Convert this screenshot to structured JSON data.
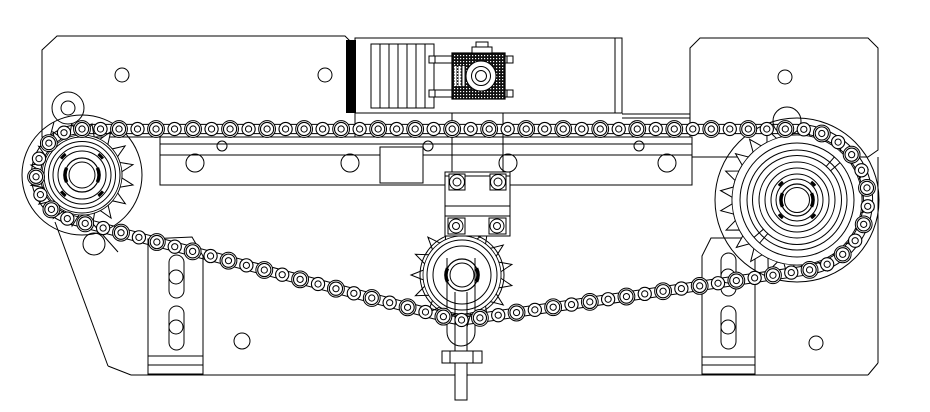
{
  "meta": {
    "background": "#ffffff",
    "line_color": "#000000",
    "fill_color": "#ffffff"
  },
  "canvas": {
    "width": 930,
    "height": 412
  },
  "chain": {
    "pitch": 18.5,
    "roller_outer_r": 6.6,
    "roller_inner_r": 3.1,
    "link_plate_r": 8.4,
    "rail_offset": 4.6
  },
  "sprockets": [
    {
      "id": "left",
      "cx": 82,
      "cy": 175,
      "teeth": 16,
      "tip_r": 52,
      "root_r": 40,
      "pitch_r": 46,
      "rings": [
        38,
        33.5,
        29,
        24
      ],
      "bore_r": 17,
      "bore_inner_r": 13,
      "phase": 11,
      "tick_r": 26.5,
      "ticks": [
        45,
        135,
        225,
        315
      ]
    },
    {
      "id": "right",
      "cx": 797,
      "cy": 200,
      "teeth": 24,
      "tip_r": 77,
      "root_r": 65,
      "pitch_r": 71,
      "rings": [
        57,
        50,
        44.5,
        38,
        32,
        26,
        21
      ],
      "bore_r": 16,
      "bore_inner_r": 12.5,
      "phase": 7,
      "tick_r": 23,
      "ticks": [
        45,
        135,
        225,
        315
      ],
      "spokes": {
        "angles": [
          131,
          139,
          311,
          319
        ],
        "r1": 44.5,
        "r2": 57
      }
    },
    {
      "id": "idler",
      "cx": 462,
      "cy": 275,
      "teeth": 15,
      "tip_r": 51,
      "root_r": 39,
      "pitch_r": 45,
      "rings": [
        42,
        35,
        29
      ],
      "bore_r": 16,
      "bore_inner_r": 12,
      "phase": 12
    }
  ],
  "layers": {
    "plates": [
      {
        "t": "poly",
        "pts": [
          [
            42,
            50
          ],
          [
            57,
            36
          ],
          [
            345,
            36
          ],
          [
            355,
            46
          ],
          [
            355,
            137
          ],
          [
            42,
            137
          ]
        ],
        "f": "#fff"
      },
      {
        "t": "rect",
        "x": 355,
        "y": 38,
        "w": 267,
        "h": 75,
        "f": "#fff"
      },
      {
        "t": "line",
        "x1": 615,
        "y1": 38,
        "x2": 615,
        "y2": 113
      },
      {
        "t": "rect",
        "x": 346,
        "y": 40,
        "w": 10,
        "h": 73,
        "f": "#000"
      },
      {
        "t": "poly",
        "pts": [
          [
            690,
            48
          ],
          [
            700,
            38
          ],
          [
            868,
            38
          ],
          [
            878,
            48
          ],
          [
            878,
            150
          ],
          [
            868,
            157
          ],
          [
            690,
            157
          ]
        ],
        "f": "#fff"
      },
      {
        "t": "line",
        "x1": 622,
        "y1": 114,
        "x2": 690,
        "y2": 114
      },
      {
        "t": "line",
        "x1": 622,
        "y1": 118,
        "x2": 690,
        "y2": 118
      },
      {
        "t": "line",
        "x1": 55,
        "y1": 222,
        "x2": 108,
        "y2": 366
      },
      {
        "t": "line",
        "x1": 77,
        "y1": 206,
        "x2": 118,
        "y2": 252
      },
      {
        "t": "line",
        "x1": 108,
        "y1": 366,
        "x2": 131,
        "y2": 375
      },
      {
        "t": "line",
        "x1": 131,
        "y1": 375,
        "x2": 868,
        "y2": 375
      },
      {
        "t": "line",
        "x1": 868,
        "y1": 375,
        "x2": 878,
        "y2": 363
      },
      {
        "t": "line",
        "x1": 878,
        "y1": 363,
        "x2": 878,
        "y2": 157
      },
      {
        "t": "line",
        "x1": 755,
        "y1": 252,
        "x2": 755,
        "y2": 374
      },
      {
        "t": "circle",
        "cx": 122,
        "cy": 75,
        "r": 7
      },
      {
        "t": "circle",
        "cx": 325,
        "cy": 75,
        "r": 7
      },
      {
        "t": "circle",
        "cx": 785,
        "cy": 77,
        "r": 7
      },
      {
        "t": "circle",
        "cx": 242,
        "cy": 341,
        "r": 8
      },
      {
        "t": "circle",
        "cx": 816,
        "cy": 343,
        "r": 7
      },
      {
        "t": "rect",
        "x": 160,
        "y": 137,
        "w": 532,
        "h": 48,
        "f": "#fff"
      },
      {
        "t": "line",
        "x1": 160,
        "y1": 144,
        "x2": 692,
        "y2": 144
      },
      {
        "t": "line",
        "x1": 160,
        "y1": 155,
        "x2": 692,
        "y2": 155
      },
      {
        "t": "rect",
        "x": 380,
        "y": 147,
        "w": 43,
        "h": 36,
        "f": "#fff"
      },
      {
        "t": "circle",
        "cx": 195,
        "cy": 163,
        "r": 9
      },
      {
        "t": "circle",
        "cx": 350,
        "cy": 163,
        "r": 9
      },
      {
        "t": "circle",
        "cx": 508,
        "cy": 163,
        "r": 9
      },
      {
        "t": "circle",
        "cx": 667,
        "cy": 163,
        "r": 9
      },
      {
        "t": "circle",
        "cx": 222,
        "cy": 146,
        "r": 5
      },
      {
        "t": "circle",
        "cx": 428,
        "cy": 146,
        "r": 5
      },
      {
        "t": "circle",
        "cx": 639,
        "cy": 146,
        "r": 5
      },
      {
        "t": "poly",
        "pts": [
          [
            148,
            239
          ],
          [
            192,
            237
          ],
          [
            203,
            256
          ],
          [
            203,
            374
          ],
          [
            148,
            374
          ]
        ],
        "f": "#fff"
      },
      {
        "t": "line",
        "x1": 148,
        "y1": 356,
        "x2": 203,
        "y2": 356
      },
      {
        "t": "line",
        "x1": 148,
        "y1": 365,
        "x2": 203,
        "y2": 365
      },
      {
        "t": "rect",
        "x": 169,
        "y": 255,
        "w": 15,
        "h": 43,
        "rx": 7.5
      },
      {
        "t": "rect",
        "x": 169,
        "y": 306,
        "w": 15,
        "h": 44,
        "rx": 7.5
      },
      {
        "t": "circle",
        "cx": 176,
        "cy": 277,
        "r": 7
      },
      {
        "t": "circle",
        "cx": 176,
        "cy": 327,
        "r": 7
      },
      {
        "t": "poly",
        "pts": [
          [
            702,
            256
          ],
          [
            711,
            238
          ],
          [
            755,
            238
          ],
          [
            755,
            374
          ],
          [
            702,
            374
          ]
        ],
        "f": "#fff"
      },
      {
        "t": "line",
        "x1": 702,
        "y1": 357,
        "x2": 755,
        "y2": 357
      },
      {
        "t": "line",
        "x1": 702,
        "y1": 365,
        "x2": 755,
        "y2": 365
      },
      {
        "t": "rect",
        "x": 721,
        "y": 253,
        "w": 15,
        "h": 43,
        "rx": 7.5
      },
      {
        "t": "rect",
        "x": 721,
        "y": 306,
        "w": 15,
        "h": 43,
        "rx": 7.5
      },
      {
        "t": "circle",
        "cx": 728,
        "cy": 276,
        "r": 7
      },
      {
        "t": "circle",
        "cx": 728,
        "cy": 327,
        "r": 7
      },
      {
        "t": "circle",
        "cx": 82,
        "cy": 175,
        "r": 60
      },
      {
        "t": "circle",
        "cx": 68,
        "cy": 108,
        "r": 16
      },
      {
        "t": "circle",
        "cx": 68,
        "cy": 108,
        "r": 7
      },
      {
        "t": "circle",
        "cx": 94,
        "cy": 244,
        "r": 11
      },
      {
        "t": "line",
        "x1": 54,
        "y1": 122,
        "x2": 46,
        "y2": 152
      },
      {
        "t": "line",
        "x1": 83,
        "y1": 123,
        "x2": 99,
        "y2": 148
      },
      {
        "t": "circle",
        "cx": 797,
        "cy": 200,
        "r": 82
      },
      {
        "t": "circle",
        "cx": 787,
        "cy": 121,
        "r": 14
      }
    ],
    "drive": [
      {
        "t": "rect",
        "x": 371,
        "y": 44,
        "w": 63,
        "h": 64,
        "f": "#fff"
      },
      {
        "t": "line",
        "x1": 380,
        "y1": 44,
        "x2": 380,
        "y2": 108
      },
      {
        "t": "line",
        "x1": 389,
        "y1": 44,
        "x2": 389,
        "y2": 108
      },
      {
        "t": "line",
        "x1": 398,
        "y1": 44,
        "x2": 398,
        "y2": 108
      },
      {
        "t": "line",
        "x1": 407,
        "y1": 44,
        "x2": 407,
        "y2": 108
      },
      {
        "t": "line",
        "x1": 416,
        "y1": 44,
        "x2": 416,
        "y2": 108
      },
      {
        "t": "line",
        "x1": 425,
        "y1": 44,
        "x2": 425,
        "y2": 108
      },
      {
        "t": "rect",
        "x": 429,
        "y": 56,
        "w": 84,
        "h": 7,
        "f": "#fff"
      },
      {
        "t": "rect",
        "x": 429,
        "y": 90,
        "w": 84,
        "h": 7,
        "f": "#fff"
      },
      {
        "t": "line",
        "x1": 435,
        "y1": 56,
        "x2": 435,
        "y2": 63
      },
      {
        "t": "line",
        "x1": 507,
        "y1": 56,
        "x2": 507,
        "y2": 63
      },
      {
        "t": "line",
        "x1": 435,
        "y1": 90,
        "x2": 435,
        "y2": 97
      },
      {
        "t": "line",
        "x1": 507,
        "y1": 90,
        "x2": 507,
        "y2": 97
      },
      {
        "t": "rect",
        "x": 452,
        "y": 53,
        "w": 53,
        "h": 46,
        "f": "url(#hatch)",
        "w2": 1.2
      },
      {
        "t": "line",
        "x1": 455.5,
        "y1": 66,
        "x2": 455.5,
        "y2": 86,
        "col": "#fff",
        "w2": 2
      },
      {
        "t": "line",
        "x1": 459.5,
        "y1": 66,
        "x2": 459.5,
        "y2": 86,
        "col": "#fff",
        "w2": 2
      },
      {
        "t": "line",
        "x1": 463.5,
        "y1": 66,
        "x2": 463.5,
        "y2": 86,
        "col": "#fff",
        "w2": 2
      },
      {
        "t": "circle",
        "cx": 481,
        "cy": 76,
        "r": 15,
        "f": "#fff"
      },
      {
        "t": "circle",
        "cx": 481,
        "cy": 76,
        "r": 9.5,
        "f": "#fff"
      },
      {
        "t": "circle",
        "cx": 481,
        "cy": 76,
        "r": 5.5,
        "f": "#fff"
      },
      {
        "t": "rect",
        "x": 472,
        "y": 47,
        "w": 20,
        "h": 6,
        "f": "#fff"
      },
      {
        "t": "rect",
        "x": 476,
        "y": 42,
        "w": 12,
        "h": 5,
        "f": "#fff"
      },
      {
        "t": "line",
        "x1": 452,
        "y1": 113,
        "x2": 452,
        "y2": 176
      },
      {
        "t": "line",
        "x1": 503,
        "y1": 113,
        "x2": 503,
        "y2": 176
      },
      {
        "t": "rect",
        "x": 445,
        "y": 172,
        "w": 65,
        "h": 64,
        "f": "#fff"
      },
      {
        "t": "line",
        "x1": 445,
        "y1": 176,
        "x2": 510,
        "y2": 176
      },
      {
        "t": "line",
        "x1": 445,
        "y1": 206,
        "x2": 510,
        "y2": 206
      },
      {
        "t": "line",
        "x1": 445,
        "y1": 216,
        "x2": 510,
        "y2": 216
      },
      {
        "t": "rect",
        "x": 449,
        "y": 174,
        "w": 16,
        "h": 16,
        "f": "#fff"
      },
      {
        "t": "rect",
        "x": 490,
        "y": 174,
        "w": 16,
        "h": 16,
        "f": "#fff"
      },
      {
        "t": "circle",
        "cx": 457,
        "cy": 182,
        "r": 7.5,
        "f": "#fff"
      },
      {
        "t": "circle",
        "cx": 457,
        "cy": 182,
        "r": 4,
        "f": "#fff"
      },
      {
        "t": "circle",
        "cx": 498,
        "cy": 182,
        "r": 7.5,
        "f": "#fff"
      },
      {
        "t": "circle",
        "cx": 498,
        "cy": 182,
        "r": 4,
        "f": "#fff"
      },
      {
        "t": "rect",
        "x": 448,
        "y": 218,
        "w": 17,
        "h": 16,
        "f": "#fff"
      },
      {
        "t": "rect",
        "x": 489,
        "y": 218,
        "w": 17,
        "h": 16,
        "f": "#fff"
      },
      {
        "t": "circle",
        "cx": 456,
        "cy": 226,
        "r": 7,
        "f": "#fff"
      },
      {
        "t": "circle",
        "cx": 456,
        "cy": 226,
        "r": 3.5,
        "f": "#fff"
      },
      {
        "t": "circle",
        "cx": 497,
        "cy": 226,
        "r": 7,
        "f": "#fff"
      },
      {
        "t": "circle",
        "cx": 497,
        "cy": 226,
        "r": 3.5,
        "f": "#fff"
      }
    ],
    "tensioner": [
      {
        "t": "path",
        "d": "M447,258 L447,332 A14,14 0 0 0 475,332 L475,258"
      },
      {
        "t": "line",
        "x1": 455,
        "y1": 292,
        "x2": 455,
        "y2": 351
      },
      {
        "t": "line",
        "x1": 467,
        "y1": 292,
        "x2": 467,
        "y2": 351
      },
      {
        "t": "rect",
        "x": 442,
        "y": 351,
        "w": 40,
        "h": 12,
        "f": "#fff"
      },
      {
        "t": "line",
        "x1": 450,
        "y1": 351,
        "x2": 450,
        "y2": 363
      },
      {
        "t": "line",
        "x1": 473,
        "y1": 351,
        "x2": 473,
        "y2": 363
      },
      {
        "t": "rect",
        "x": 455,
        "y": 363,
        "w": 12,
        "h": 37,
        "f": "#fff"
      }
    ]
  }
}
